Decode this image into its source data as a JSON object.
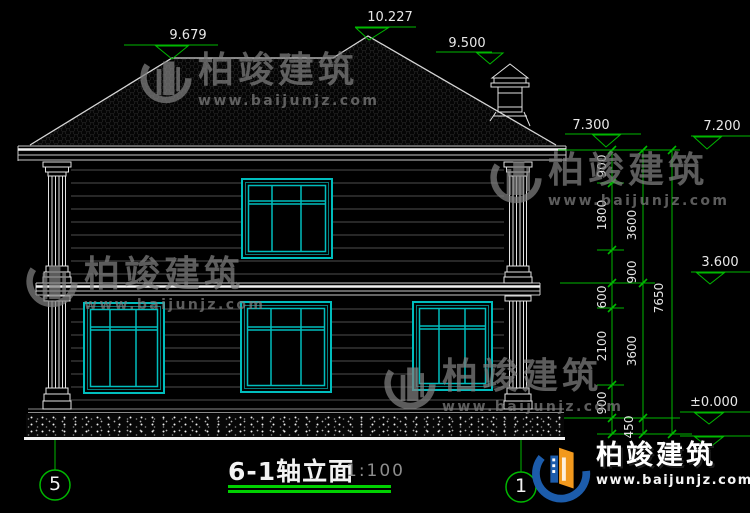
{
  "drawing": {
    "title": "6-1轴立面",
    "scale": "1:100",
    "levels": {
      "ridge_left": "9.679",
      "ridge_main": "10.227",
      "chimney": "9.500",
      "eave": "7.300",
      "eave_struct": "7.200",
      "floor2": "3.600",
      "ground": "±0.000"
    },
    "dims_inner": [
      "900",
      "1800",
      "600",
      "2100",
      "900"
    ],
    "dims_mid": [
      "3600",
      "900",
      "3600",
      "450"
    ],
    "dims_total": "7650",
    "axis_left": "5",
    "axis_right": "1"
  },
  "watermark": {
    "name": "柏竣建筑",
    "site": "www.baijunjz.com"
  },
  "brand": {
    "name": "柏竣建筑",
    "site": "www.baijunjz.com"
  }
}
